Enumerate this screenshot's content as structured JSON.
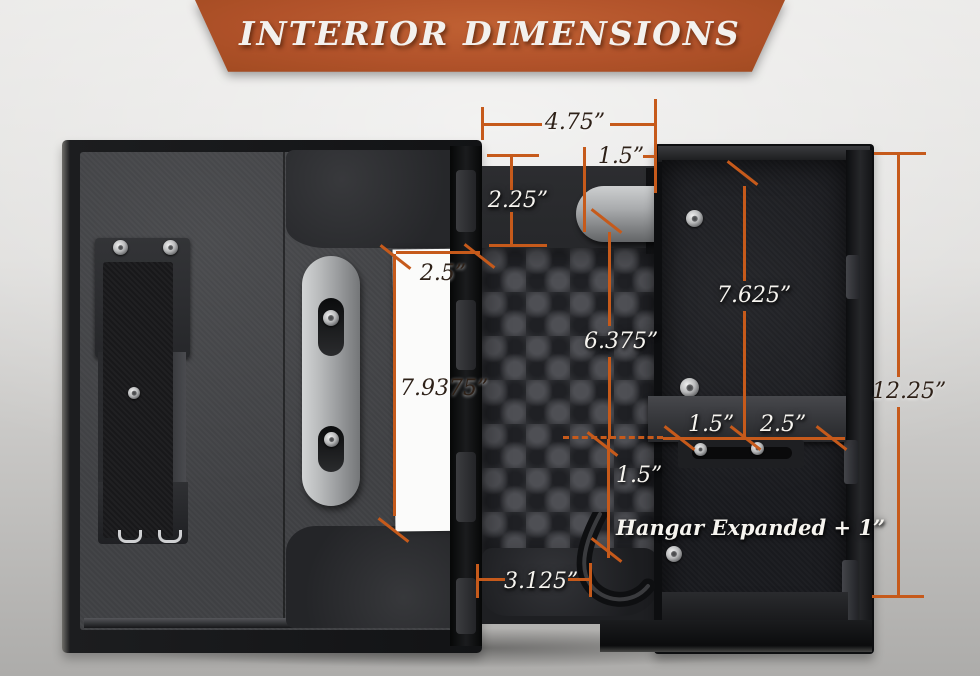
{
  "banner": {
    "title": "INTERIOR DIMENSIONS"
  },
  "colors": {
    "accent": "#c65a1b",
    "banner_top": "#c06133",
    "banner_bottom": "#a04a20",
    "label_dark": "#2e2118",
    "label_light": "#f6f4ef"
  },
  "annotations": {
    "top_width": "4.75”",
    "top_offset": "1.5”",
    "door_depth": "2.25”",
    "card_width": "2.5”",
    "card_height": "7.9375”",
    "center_height": "6.375”",
    "right_depth": "7.625”",
    "shelf_left": "1.5”",
    "shelf_right": "2.5”",
    "overall_height": "12.25”",
    "hangar_drop": "1.5”",
    "hangar_note": "Hangar Expanded + 1”",
    "bottom_width": "3.125”"
  }
}
